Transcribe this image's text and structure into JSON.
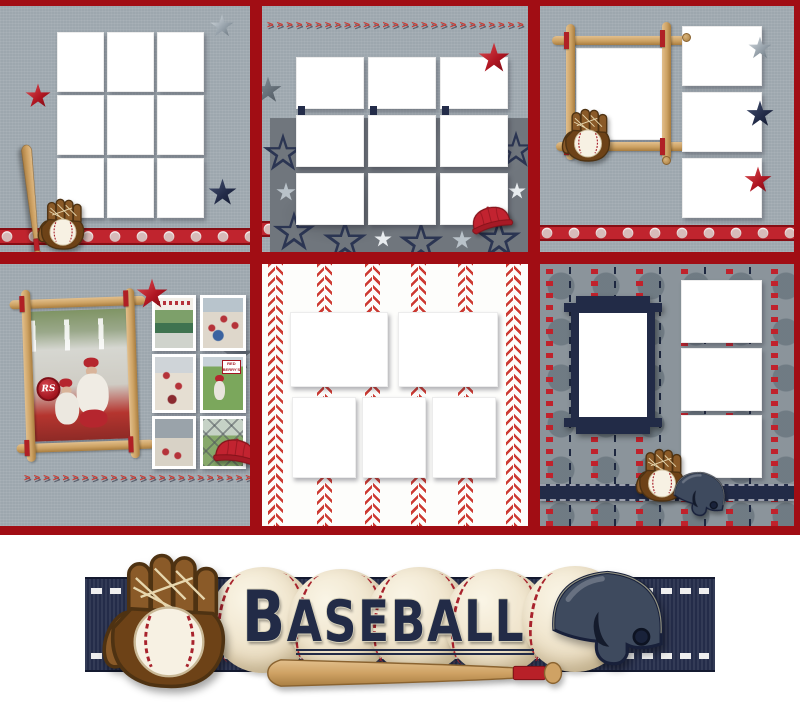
{
  "page": {
    "type": "scrapbook-collage-preview",
    "theme": "baseball"
  },
  "banner": {
    "title": "BASEBALL"
  },
  "decor": {
    "stitch_char": ">"
  },
  "colors": {
    "border_red": "#a10d14",
    "ribbon_red": "#c0242e",
    "stitch_red": "#cd3a32",
    "navy": "#232c49",
    "linen_gray": "#9da7ae",
    "star_paper_gray": "#70767d",
    "dot_paper_gray": "#8b949b",
    "bat_tan": "#cfa264",
    "glove_brown": "#7a4a1c",
    "ball_cream": "#f5efdf",
    "slot_white": "#ffffff"
  },
  "panels": [
    {
      "id": "p1",
      "name": "linen-nine-grid",
      "photo_slots": 9,
      "decorations": [
        "silver star",
        "red star",
        "navy star",
        "baseball bat",
        "glove with baseball",
        "baseball ribbon"
      ]
    },
    {
      "id": "p2",
      "name": "star-paper-nine-grid",
      "photo_slots": 9,
      "decorations": [
        "stitch row",
        "red star",
        "gray star",
        "red cap",
        "star paper"
      ]
    },
    {
      "id": "p3",
      "name": "bat-frame-with-three",
      "photo_slots": 4,
      "decorations": [
        "bat frame",
        "glove with baseball",
        "silver star",
        "navy star",
        "red star",
        "baseball ribbon"
      ]
    },
    {
      "id": "p4",
      "name": "filled-example-page",
      "photo_slots": 7,
      "sign_text": "RED BERRY'S",
      "badge_text": "RS",
      "decorations": [
        "tilted bat frame",
        "red star",
        "gray star",
        "red cap",
        "stitch row"
      ],
      "photos": [
        "man and boy in red caps",
        "boy with glove under banner",
        "team crowd",
        "team group",
        "toddler batting by sign",
        "crowd at stands",
        "player behind fence"
      ]
    },
    {
      "id": "p5",
      "name": "stitch-stripe-five-grid",
      "photo_slots": 5,
      "decorations": [
        "vertical baseball stitch stripes"
      ]
    },
    {
      "id": "p6",
      "name": "dot-paper-with-navy-frame",
      "photo_slots": 4,
      "decorations": [
        "navy bracket frame",
        "glove with baseball",
        "navy helmet",
        "navy stitched ribbon",
        "red star stripes"
      ]
    }
  ]
}
